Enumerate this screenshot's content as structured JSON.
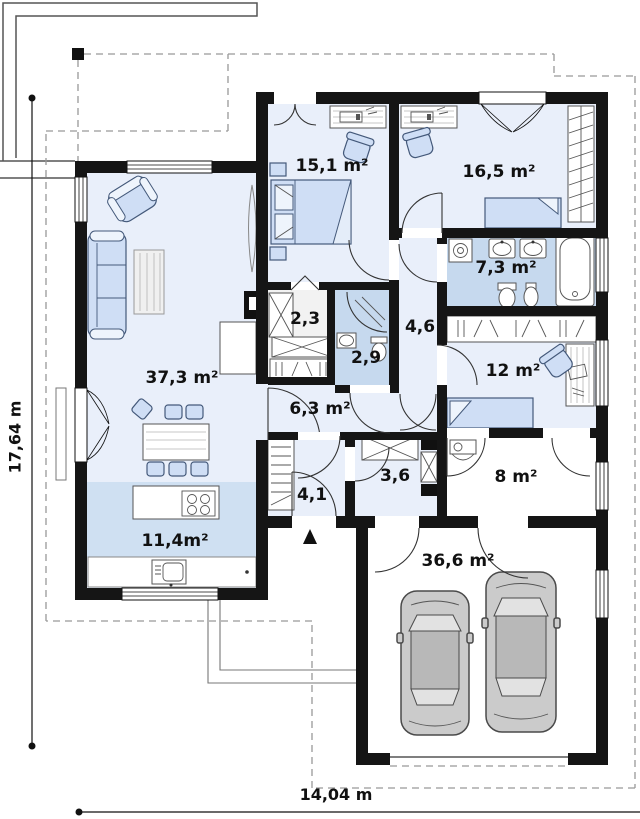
{
  "plan": {
    "type": "house-floor-plan",
    "rooms": [
      {
        "id": "living-room",
        "area_label": "37,3 m²"
      },
      {
        "id": "kitchen",
        "area_label": "11,4m²"
      },
      {
        "id": "bedroom-1",
        "area_label": "15,1 m²"
      },
      {
        "id": "bedroom-2",
        "area_label": "16,5 m²"
      },
      {
        "id": "bathroom",
        "area_label": "7,3 m²"
      },
      {
        "id": "closet",
        "area_label": "2,3"
      },
      {
        "id": "shower-room",
        "area_label": "2,9"
      },
      {
        "id": "corridor",
        "area_label": "4,6"
      },
      {
        "id": "bedroom-3",
        "area_label": "12 m²"
      },
      {
        "id": "hall",
        "area_label": "6,3 m²"
      },
      {
        "id": "entrance-hall",
        "area_label": "4,1"
      },
      {
        "id": "utility-room",
        "area_label": "3,6"
      },
      {
        "id": "storage-room",
        "area_label": "8 m²"
      },
      {
        "id": "garage",
        "area_label": "36,6 m²"
      }
    ],
    "dimensions": {
      "height_label": "17,64 m",
      "width_label": "14,04 m"
    },
    "colors": {
      "wall": "#151515",
      "room_fill": "#e9effa",
      "wet_room_fill": "#c6d9ee",
      "kitchen_zone_fill": "#cfe0f2",
      "furniture_fill": "#cfdef5",
      "car_fill": "#cbcbcb",
      "roof_outline_dashed": "#999999"
    }
  }
}
